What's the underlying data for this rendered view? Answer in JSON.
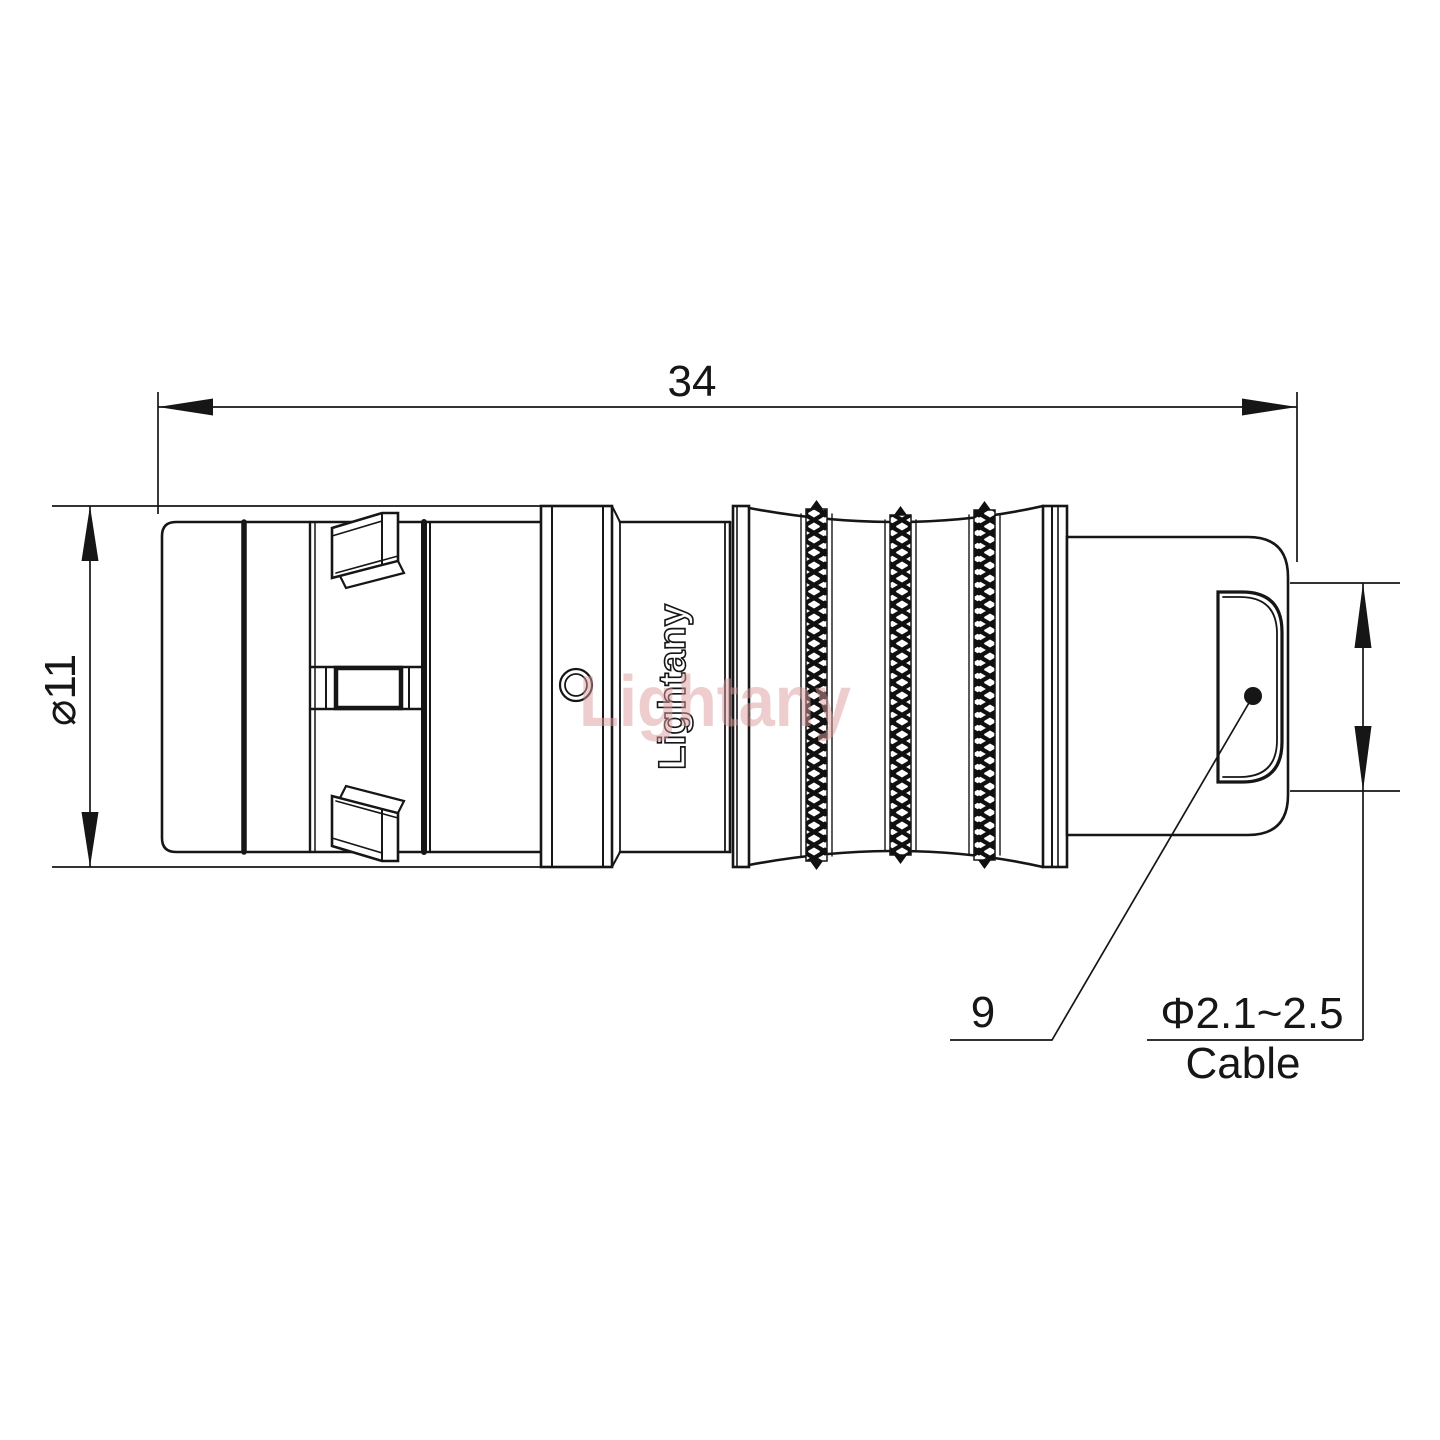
{
  "drawing": {
    "watermark": "Lightany",
    "part_marking": "Lightany",
    "dimensions": {
      "overall_length": "34",
      "body_diameter": "⌀11",
      "boot_ref": "9",
      "cable_diameter": "Φ2.1~2.5",
      "cable_word": "Cable"
    },
    "colors": {
      "line": "#161616",
      "watermark": "#dc9c9c"
    }
  }
}
